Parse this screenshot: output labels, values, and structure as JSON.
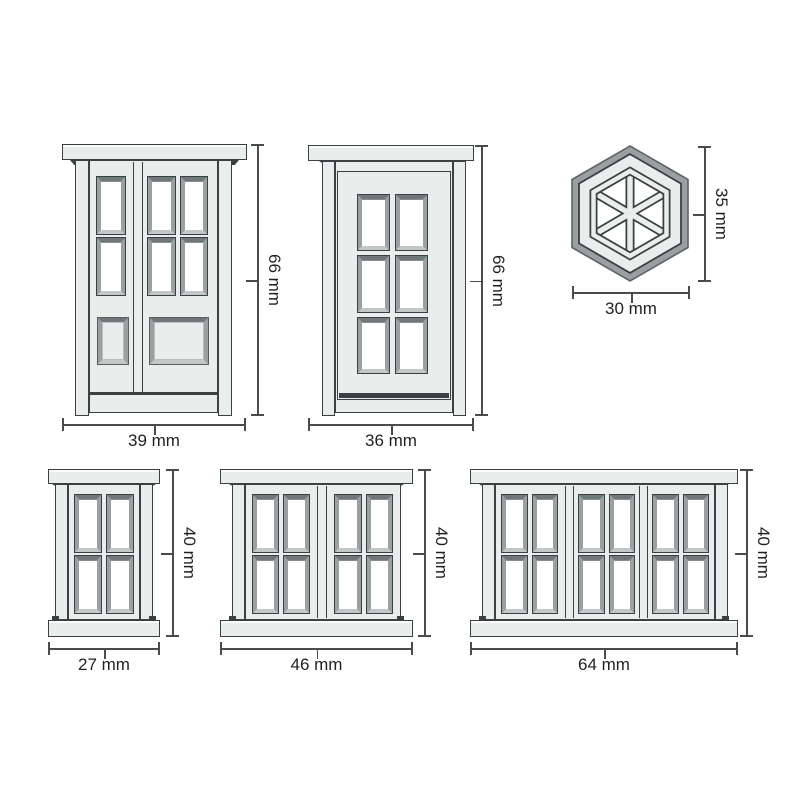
{
  "colors": {
    "face": "#e9edeb",
    "face_shade": "#e2e7e5",
    "outline": "#3a4143",
    "bevel_top": "#70787b",
    "bevel_side": "#9aa1a3",
    "bevel_bottom": "#c2c8c8",
    "glass": "#ffffff",
    "hex_rim": "#9aa0a1",
    "dim_line": "#4b4b4d",
    "text": "#231f20",
    "background": "#ffffff"
  },
  "figures": {
    "double_door": {
      "width_label": "39 mm",
      "height_label": "66 mm"
    },
    "single_door": {
      "width_label": "36 mm",
      "height_label": "66 mm"
    },
    "hex_window": {
      "width_label": "30 mm",
      "height_label": "35 mm"
    },
    "small_window": {
      "width_label": "27 mm",
      "height_label": "40 mm"
    },
    "medium_window": {
      "width_label": "46 mm",
      "height_label": "40 mm"
    },
    "wide_window": {
      "width_label": "64 mm",
      "height_label": "40 mm"
    }
  }
}
